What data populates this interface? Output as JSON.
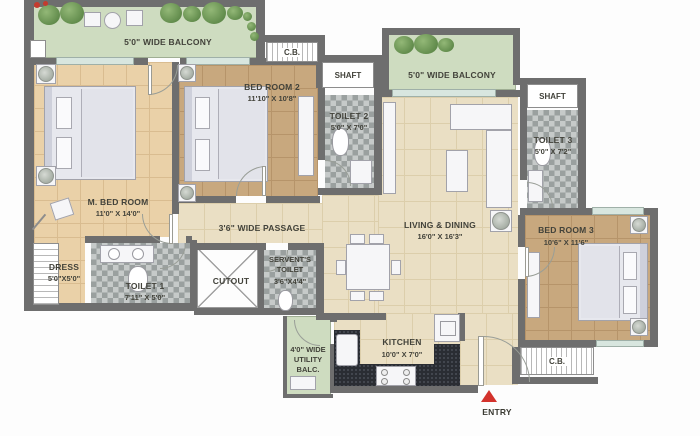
{
  "plan": {
    "balcony_top_left": {
      "label": "5'0\" WIDE BALCONY"
    },
    "cb_top": {
      "label": "C.B."
    },
    "shaft_top": {
      "label": "SHAFT"
    },
    "balcony_top_right": {
      "label": "5'0\" WIDE BALCONY"
    },
    "shaft_right": {
      "label": "SHAFT"
    },
    "m_bedroom": {
      "label": "M. BED ROOM",
      "dims": "11'0\" X 14'0\""
    },
    "bedroom2": {
      "label": "BED ROOM 2",
      "dims": "11'10\" X 10'8\""
    },
    "toilet2": {
      "label": "TOILET 2",
      "dims": "5'0\" X 7'0\""
    },
    "toilet3": {
      "label": "TOILET 3",
      "dims": "5'0\" X 7'2\""
    },
    "living_dining": {
      "label": "LIVING & DINING",
      "dims": "16'0\" X 16'3\""
    },
    "passage": {
      "label": "3'6\" WIDE PASSAGE"
    },
    "dress": {
      "label": "DRESS",
      "dims": "5'0\"X5'0\""
    },
    "toilet1": {
      "label": "TOILET 1",
      "dims": "7'11\" X 5'0\""
    },
    "cutout": {
      "label": "CUTOUT"
    },
    "servant_toilet": {
      "line1": "SERVENT'S",
      "line2": "TOILET",
      "dims": "3'6\"X4'4\""
    },
    "utility_balcony": {
      "line1": "4'0\" WIDE",
      "line2": "UTILITY",
      "line3": "BALC."
    },
    "kitchen": {
      "label": "KITCHEN",
      "dims": "10'0\" X 7'0\""
    },
    "bedroom3": {
      "label": "BED ROOM 3",
      "dims": "10'6\" X 11'6\""
    },
    "cb_bottom": {
      "label": "C.B."
    },
    "entry": {
      "label": "ENTRY"
    }
  },
  "colors": {
    "wall": "#6e6e6e",
    "balcony_green": "#cedcc0",
    "floor_tan": "#ead1a8",
    "floor_brown": "#c8a87e",
    "floor_cream": "#eadfc4",
    "tile_gray": "#aab0af",
    "counter_black": "#2a2d33",
    "entry_red": "#d3322c",
    "label_text": "#42423a"
  }
}
